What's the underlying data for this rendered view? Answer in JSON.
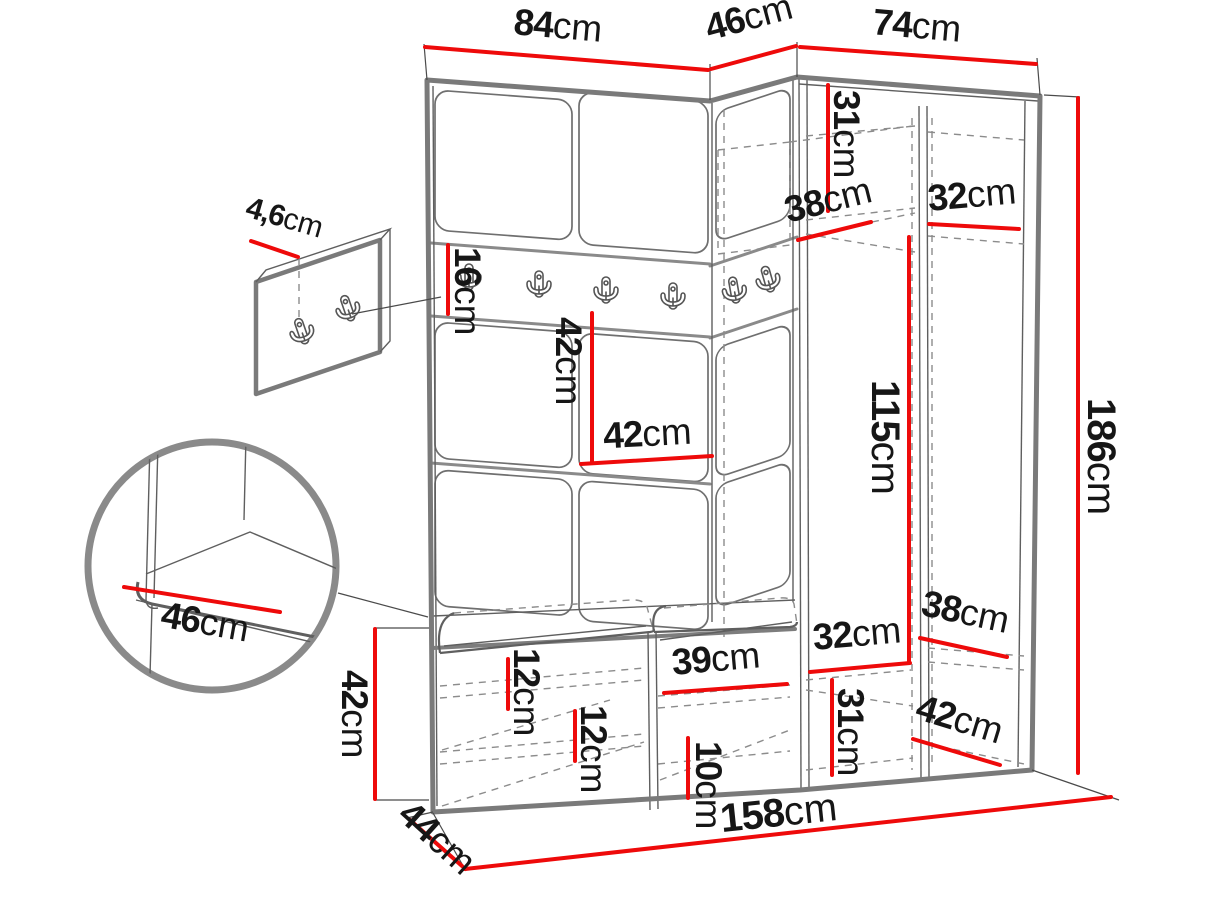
{
  "figure": {
    "type": "furniture-dimension-diagram",
    "background": "#ffffff",
    "unit": "cm"
  },
  "colors": {
    "dimension_red": "#ee0a0a",
    "outline_gray": "#7a7a7a",
    "sketch_gray": "#5f5f5f",
    "dash_gray": "#8c8c8c",
    "text_black": "#161616"
  },
  "icons": {
    "coat_hook": "double-prong-coat-hook"
  },
  "dims": {
    "width_left_top": {
      "value": "84",
      "unit": "cm"
    },
    "width_corner_top": {
      "value": "46",
      "unit": "cm"
    },
    "width_right_top": {
      "value": "74",
      "unit": "cm"
    },
    "panel_thickness": {
      "value": "4,6",
      "unit": "cm"
    },
    "rail_height": {
      "value": "16",
      "unit": "cm"
    },
    "panel_height_mid": {
      "value": "42",
      "unit": "cm"
    },
    "panel_width_mid": {
      "value": "42",
      "unit": "cm"
    },
    "shelf_top_height": {
      "value": "31",
      "unit": "cm"
    },
    "shelf_corner_depth": {
      "value": "38",
      "unit": "cm"
    },
    "shelf_right_depth_top": {
      "value": "32",
      "unit": "cm"
    },
    "hanging_height": {
      "value": "115",
      "unit": "cm"
    },
    "total_height": {
      "value": "186",
      "unit": "cm"
    },
    "seat_depth_detail": {
      "value": "46",
      "unit": "cm"
    },
    "bench_height": {
      "value": "42",
      "unit": "cm"
    },
    "bench_depth": {
      "value": "44",
      "unit": "cm"
    },
    "bench_shelf_top": {
      "value": "12",
      "unit": "cm"
    },
    "bench_shelf_bottom": {
      "value": "12",
      "unit": "cm"
    },
    "bench_right_width": {
      "value": "39",
      "unit": "cm"
    },
    "plinth_height": {
      "value": "10",
      "unit": "cm"
    },
    "shelf_bottom_left_width": {
      "value": "32",
      "unit": "cm"
    },
    "shelf_bottom_right_depth": {
      "value": "38",
      "unit": "cm"
    },
    "shelf_bottom_height": {
      "value": "31",
      "unit": "cm"
    },
    "bottom_right_depth": {
      "value": "42",
      "unit": "cm"
    },
    "total_width": {
      "value": "158",
      "unit": "cm"
    }
  }
}
